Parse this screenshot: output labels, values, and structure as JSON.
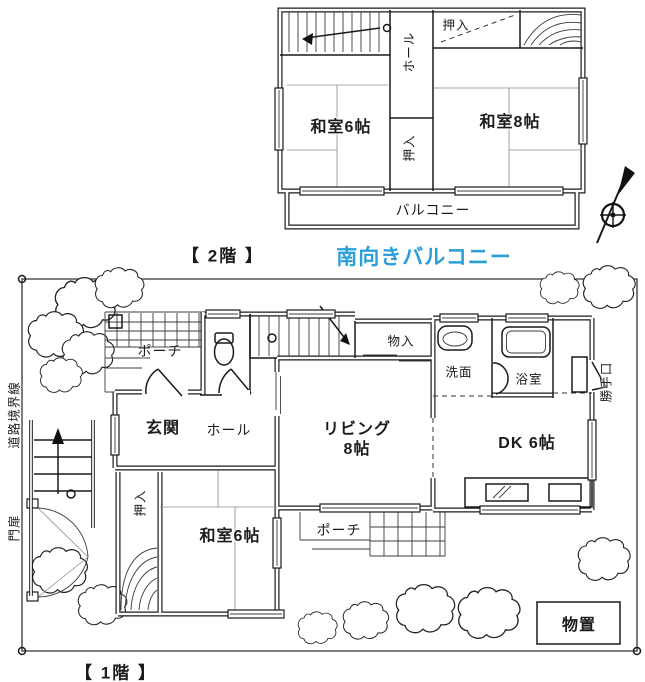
{
  "colors": {
    "accent_blue": "#2A9FD8",
    "line": "#1a1a1a"
  },
  "floor2": {
    "caption": "【 2階 】",
    "highlight": "南向きバルコニー",
    "labels": {
      "oshiire_top": "押入",
      "hall": "ホール",
      "washitsu6": "和室6帖",
      "washitsu8": "和室8帖",
      "oshiire_mid": "押入",
      "balcony": "バルコニー"
    }
  },
  "floor1": {
    "caption": "【 1階 】",
    "labels": {
      "porch_top": "ポーチ",
      "genkan": "玄関",
      "hall": "ホール",
      "mono_ire": "物入",
      "senmen": "洗面",
      "yokushitsu": "浴室",
      "living_line1": "リビング",
      "living_line2": "8帖",
      "dk": "DK 6帖",
      "washitsu6": "和室6帖",
      "oshiire": "押入",
      "porch_bottom": "ポーチ",
      "katteguchi": "勝手口",
      "monooki": "物置"
    },
    "site_labels": {
      "road_boundary": "道路境界線",
      "gate": "門扉"
    }
  }
}
